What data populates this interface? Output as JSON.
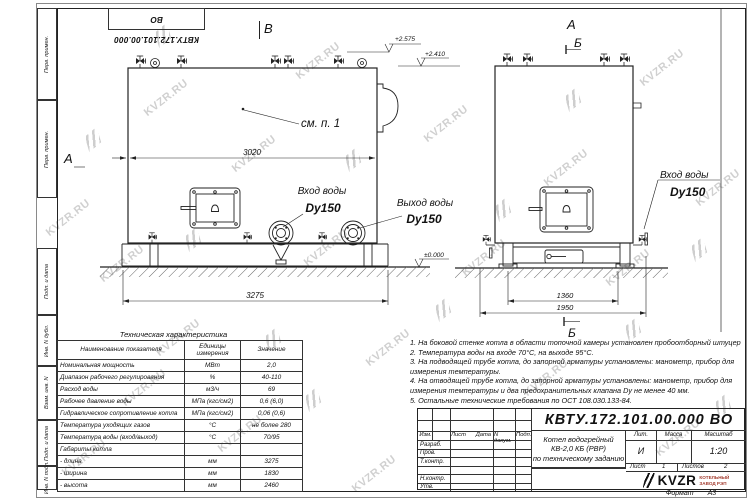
{
  "watermark": {
    "text": "KVZR.RU"
  },
  "frame": {
    "doc_number_flipped": "КВТУ.172.101.00.000 ВО",
    "margins": [
      "Перв. примен.",
      "Перв. примен.",
      "Подп. и дата",
      "Инв. N дубл.",
      "Взам. инв. N",
      "Подп. и дата",
      "Инв. N подл."
    ]
  },
  "views": {
    "front": {
      "label_a": "А",
      "label_b": "В",
      "see_note": "см. п. 1",
      "dim_body": "3020",
      "dim_base": "3275",
      "elev_top": "+2.575",
      "elev_mid": "+2.410",
      "elev_zero": "±0.000",
      "inlet": "Вход воды",
      "inlet_dn": "Dy150",
      "outlet": "Выход воды",
      "outlet_dn": "Dy150"
    },
    "side": {
      "label_a": "А",
      "label_b_top": "Б",
      "label_b_bottom": "Б",
      "dim_inner": "1360",
      "dim_outer": "1950",
      "inlet": "Вход воды",
      "inlet_dn": "Dy150"
    }
  },
  "spec_table": {
    "title": "Техническая характеристика",
    "headers": [
      "Наименование показателя",
      "Единицы измерения",
      "Значение"
    ],
    "rows": [
      {
        "name": "Номинальная мощность",
        "unit": "МВт",
        "value": "2,0"
      },
      {
        "name": "Диапазон рабочего регулирования",
        "unit": "%",
        "value": "40-110"
      },
      {
        "name": "Расход воды",
        "unit": "м3/ч",
        "value": "69"
      },
      {
        "name": "Рабочее давление воды",
        "unit": "МПа (кгс/см2)",
        "value": "0,6 (6,0)"
      },
      {
        "name": "Гидравлическое сопротивление котла",
        "unit": "МПа (кгс/см2)",
        "value": "0,06 (0,6)"
      },
      {
        "name": "Температура уходящих газов",
        "unit": "°С",
        "value": "не более 280"
      },
      {
        "name": "Температура воды (вход/выход)",
        "unit": "°С",
        "value": "70/95"
      },
      {
        "name": "Габариты котла",
        "unit": "",
        "value": ""
      },
      {
        "name": "- длина",
        "unit": "мм",
        "value": "3275"
      },
      {
        "name": "- ширина",
        "unit": "мм",
        "value": "1830"
      },
      {
        "name": "- высота",
        "unit": "мм",
        "value": "2460"
      }
    ]
  },
  "notes": [
    "1. На боковой стенке котла в области топочной камеры установлен пробоотборный штуцер",
    "2. Температура воды на входе 70°С, на выходе 95°С.",
    "3. На подводящей трубе котла, до запорной арматуры установлены: манометр, прибор для измерения температуры.",
    "4. На отводящей трубе котла, до запорной арматуры установлены: манометр, прибор для измерения температуры и два предохранительных клапана Dу не менее 40 мм.",
    "5. Остальные технические требования по ОСТ 108.030.133-84."
  ],
  "title_block": {
    "doc_number": "КВТУ.172.101.00.000 ВО",
    "product_line1": "Котел водогрейный",
    "product_line2": "КВ-2,0 КБ (РВР)",
    "product_line3": "по техническому заданию",
    "cols": {
      "izm": "Изм.",
      "list": "Лист",
      "ndoc": "N докум.",
      "podp": "Подп.",
      "data": "Дата"
    },
    "rows": {
      "razrab": "Разраб.",
      "prov": "Пров.",
      "tkontr": "Т.контр.",
      "nkontr": "Н.контр.",
      "utv": "Утв."
    },
    "lit_label": "Лит.",
    "mass_label": "Масса",
    "scale_label": "Масштаб",
    "lit_value": "И",
    "mass_value": "",
    "scale_value": "1:20",
    "sheet_label": "Лист",
    "sheet_value": "1",
    "sheets_label": "Листов",
    "sheets_value": "2",
    "company": {
      "logo": "KVZR",
      "line1": "КОТЕЛЬНЫЙ",
      "line2": "ЗАВОД РЭП"
    },
    "format_label": "Формат",
    "format_value": "А3"
  }
}
